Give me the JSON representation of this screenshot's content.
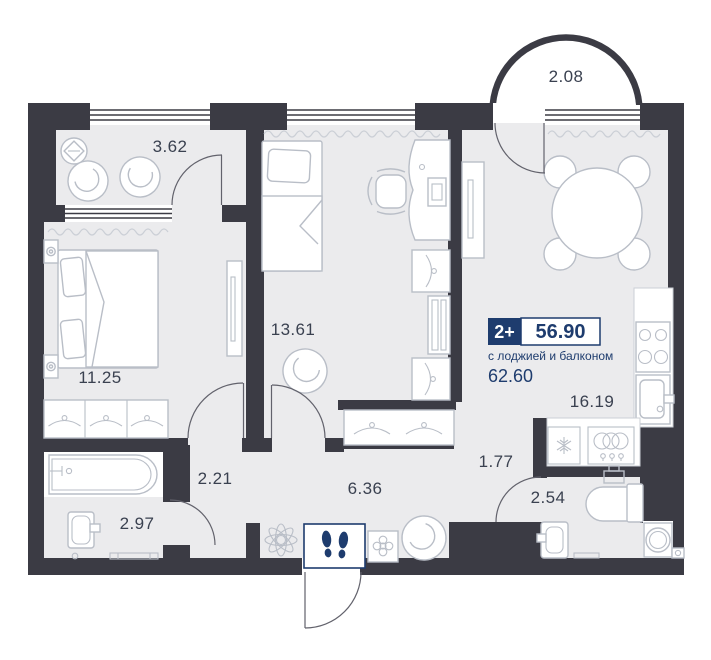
{
  "unit": {
    "rooms_label": "2+",
    "area_main": "56.90",
    "subtitle": "с лоджией и балконом",
    "area_total": "62.60"
  },
  "rooms": {
    "loggia": {
      "name": "loggia",
      "area": "3.62"
    },
    "balcony": {
      "name": "balcony",
      "area": "2.08"
    },
    "bedroom_1": {
      "name": "bedroom",
      "area": "11.25"
    },
    "bedroom_2": {
      "name": "bedroom-study",
      "area": "13.61"
    },
    "kitchen_living": {
      "name": "kitchen-living-room",
      "area": "16.19"
    },
    "hall": {
      "name": "entrance-hall",
      "area": "6.36"
    },
    "corridor": {
      "name": "corridor",
      "area": "1.77"
    },
    "inner_hall": {
      "name": "inner-hallway",
      "area": "2.21"
    },
    "bathroom": {
      "name": "bathroom",
      "area": "2.97"
    },
    "wc": {
      "name": "wc",
      "area": "2.54"
    }
  },
  "colors": {
    "wall": "#3B3B44",
    "floor": "#EBEBED",
    "furniture_line": "#B9BEC7",
    "accent_navy": "#1E3C6E",
    "label_text": "#3A4150"
  },
  "icons": {
    "entrance_marker": "footprints-icon",
    "hall_decor": [
      "flower-icon",
      "plant-cabinet-icon",
      "pouf-icon"
    ],
    "kitchen": [
      "stove-burners-icon",
      "kitchen-sink-icon",
      "fridge-snowflake-icon",
      "dishes-icon"
    ],
    "bathroom": [
      "bathtub-icon",
      "washbasin-icon",
      "bath-mat-icon"
    ],
    "wc": [
      "toilet-icon",
      "washbasin-icon",
      "washing-machine-icon"
    ],
    "storage": "hanger-icon"
  }
}
